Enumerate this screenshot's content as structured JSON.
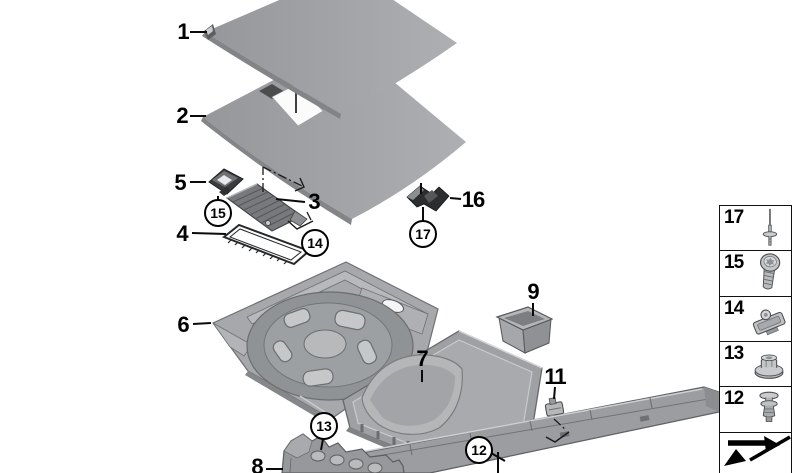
{
  "page": {
    "background": "#ffffff"
  },
  "diagram": {
    "callouts": {
      "p1": "1",
      "p2": "2",
      "p3": "3",
      "p4": "4",
      "p5": "5",
      "p6": "6",
      "p7": "7",
      "p8": "8",
      "p9": "9",
      "p11": "11",
      "p16": "16"
    },
    "circled_callouts": {
      "c12": "12",
      "c13": "13",
      "c14": "14",
      "c15": "15",
      "c17": "17"
    },
    "colors": {
      "part_fill": "#a2a4a7",
      "part_fill_dark": "#2e2f31",
      "outline": "#1a1a1a",
      "label_text": "#000000",
      "leader_line": "#000000",
      "legend_border": "#111111"
    }
  },
  "legend": {
    "rows": [
      {
        "number": "17",
        "icon": "washer-pin-screw-icon"
      },
      {
        "number": "15",
        "icon": "torx-screw-icon"
      },
      {
        "number": "14",
        "icon": "clip-nut-icon"
      },
      {
        "number": "13",
        "icon": "flange-nut-icon"
      },
      {
        "number": "12",
        "icon": "expanding-rivet-icon"
      },
      {
        "number": "",
        "icon": "bent-arrow-icon"
      }
    ]
  }
}
